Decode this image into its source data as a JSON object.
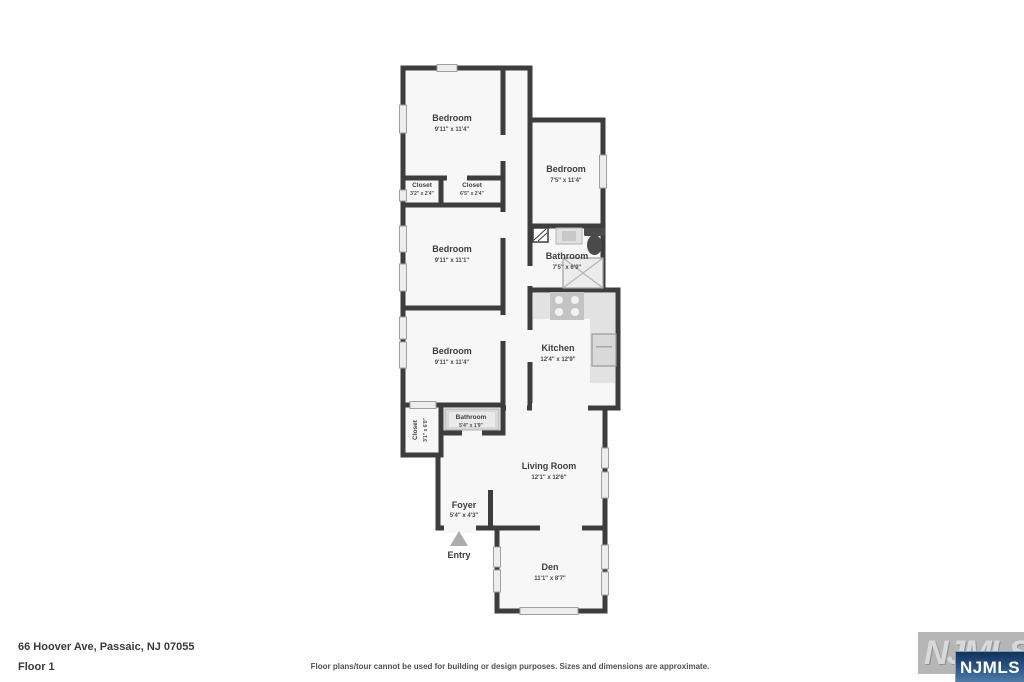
{
  "plan": {
    "rooms": [
      {
        "name": "Bedroom",
        "dims": "9'11\" x 11'4\""
      },
      {
        "name": "Closet",
        "dims": "3'2\" x 2'4\""
      },
      {
        "name": "Closet",
        "dims": "6'5\" x 2'4\""
      },
      {
        "name": "Bedroom",
        "dims": "9'11\" x 11'1\""
      },
      {
        "name": "Bedroom",
        "dims": "9'11\" x 11'4\""
      },
      {
        "name": "Closet",
        "dims": "3'1\" x 6'0\""
      },
      {
        "name": "Bathroom",
        "dims": "5'4\" x 1'9\""
      },
      {
        "name": "Bedroom",
        "dims": "7'5\" x 11'4\""
      },
      {
        "name": "Bathroom",
        "dims": "7'5\" x 6'9\""
      },
      {
        "name": "Kitchen",
        "dims": "12'4\" x 12'9\""
      },
      {
        "name": "Living Room",
        "dims": "12'1\" x 12'6\""
      },
      {
        "name": "Foyer",
        "dims": "5'4\" x 4'3\""
      },
      {
        "name": "Den",
        "dims": "11'1\" x 8'7\""
      }
    ],
    "entry_label": "Entry"
  },
  "footer": {
    "address": "66 Hoover Ave, Passaic, NJ 07055",
    "floor": "Floor 1",
    "disclaimer": "Floor plans/tour cannot be used for building or design purposes. Sizes and dimensions are approximate."
  },
  "logo": {
    "watermark": "NJMLS",
    "badge": "NJMLS"
  },
  "colors": {
    "wall": "#3d3d3d",
    "room_fill": "#f7f7f7",
    "badge_blue_top": "#16365f",
    "badge_blue_bottom": "#4d7ca6"
  }
}
